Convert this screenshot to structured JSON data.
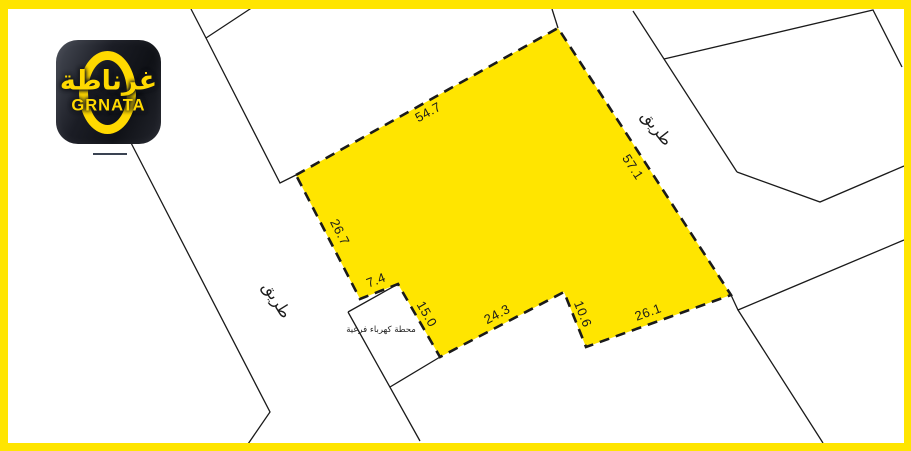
{
  "colors": {
    "accent_yellow": "#FFE500",
    "plot_fill": "#FFE500",
    "line_black": "#1A1A1A",
    "logo_yellow": "#FFD900",
    "logo_background": "#14161C"
  },
  "logo": {
    "arabic_name": "غرناطة",
    "latin_name": "GRNATA"
  },
  "map": {
    "road_label_left": "طريق",
    "road_label_right": "طريق",
    "substation_label": "محطة كهرباء فرعية"
  },
  "plot": {
    "dimensions": [
      {
        "side": "top",
        "value": "54.7"
      },
      {
        "side": "right",
        "value": "57.1"
      },
      {
        "side": "left",
        "value": "26.7"
      },
      {
        "side": "notch-top",
        "value": "7.4"
      },
      {
        "side": "notch-right",
        "value": "15.0"
      },
      {
        "side": "bottom-left",
        "value": "24.3"
      },
      {
        "side": "wedge-right",
        "value": "10.6"
      },
      {
        "side": "bottom-right",
        "value": "26.1"
      }
    ]
  }
}
